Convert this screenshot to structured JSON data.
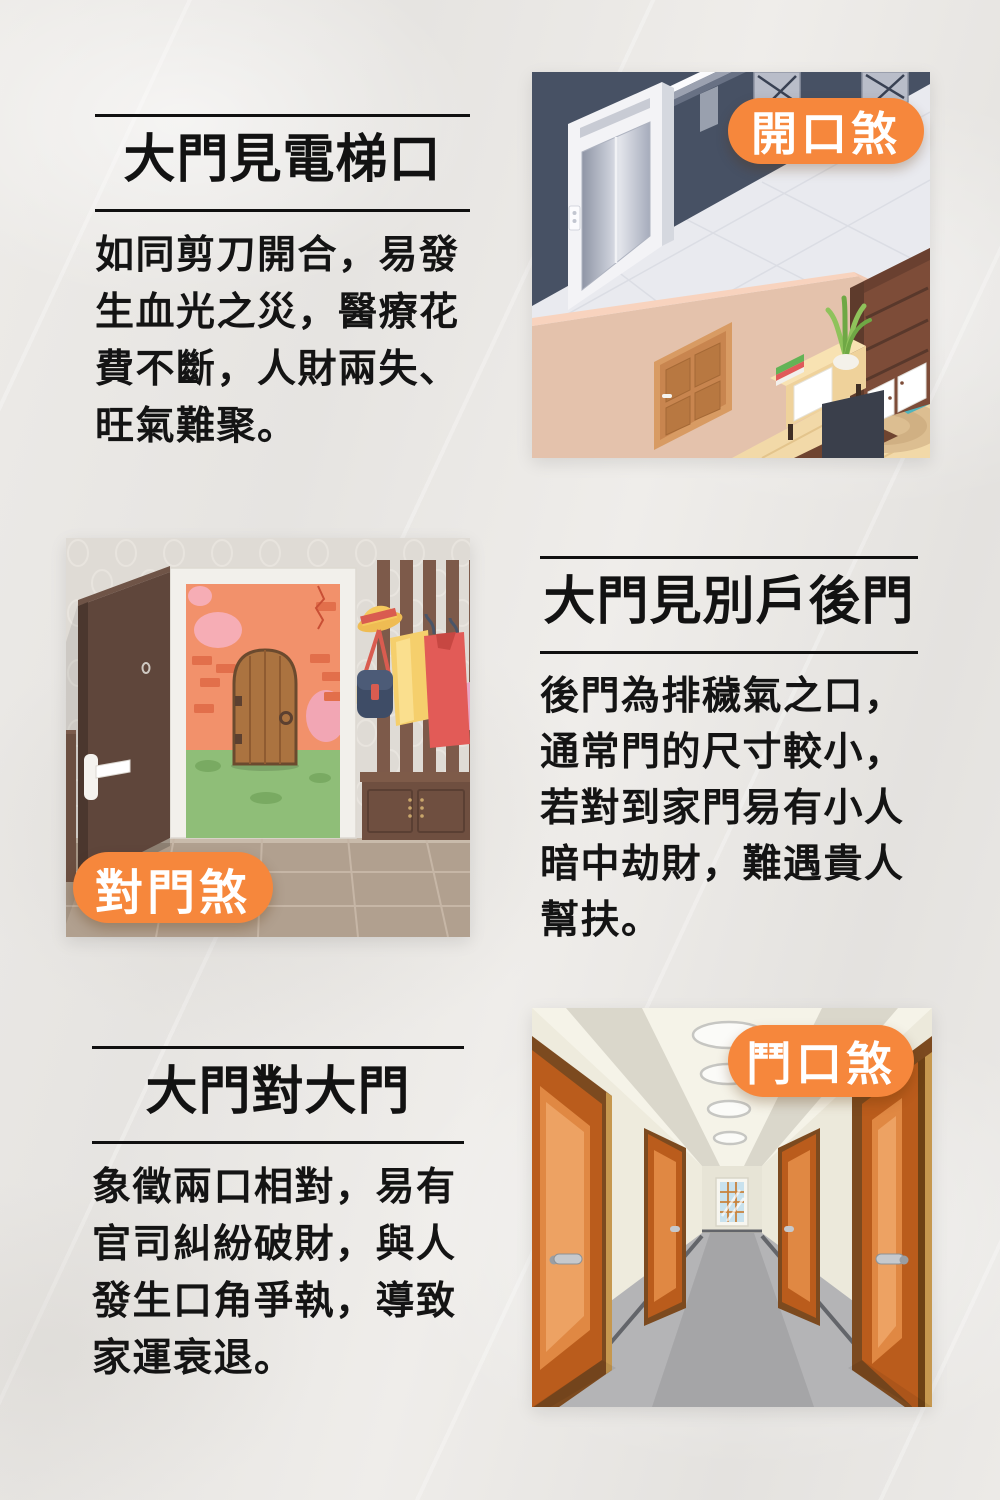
{
  "page": {
    "background": "#E9E7E4"
  },
  "theme": {
    "badge_color": "#F6873C",
    "badge_text_color": "#FFFFFF",
    "text_color": "#141414",
    "rule_color": "#101010"
  },
  "sections": [
    {
      "title": "大門見電梯口",
      "body": "如同剪刀開合，易發\n生血光之災，醫療花\n費不斷，人財兩失、\n旺氣難聚。",
      "badge": "開口煞",
      "illustration": "elevator-lobby-scene"
    },
    {
      "title": "大門見別戶後門",
      "body": "後門為排穢氣之口，\n通常門的尺寸較小，\n若對到家門易有小人\n暗中劫財，難遇貴人\n幫扶。",
      "badge": "對門煞",
      "illustration": "open-door-facing-door-scene"
    },
    {
      "title": "大門對大門",
      "body": "象徵兩口相對，易有\n官司糾紛破財，與人\n發生口角爭執，導致\n家運衰退。",
      "badge": "鬥口煞",
      "illustration": "corridor-facing-doors-scene"
    }
  ]
}
